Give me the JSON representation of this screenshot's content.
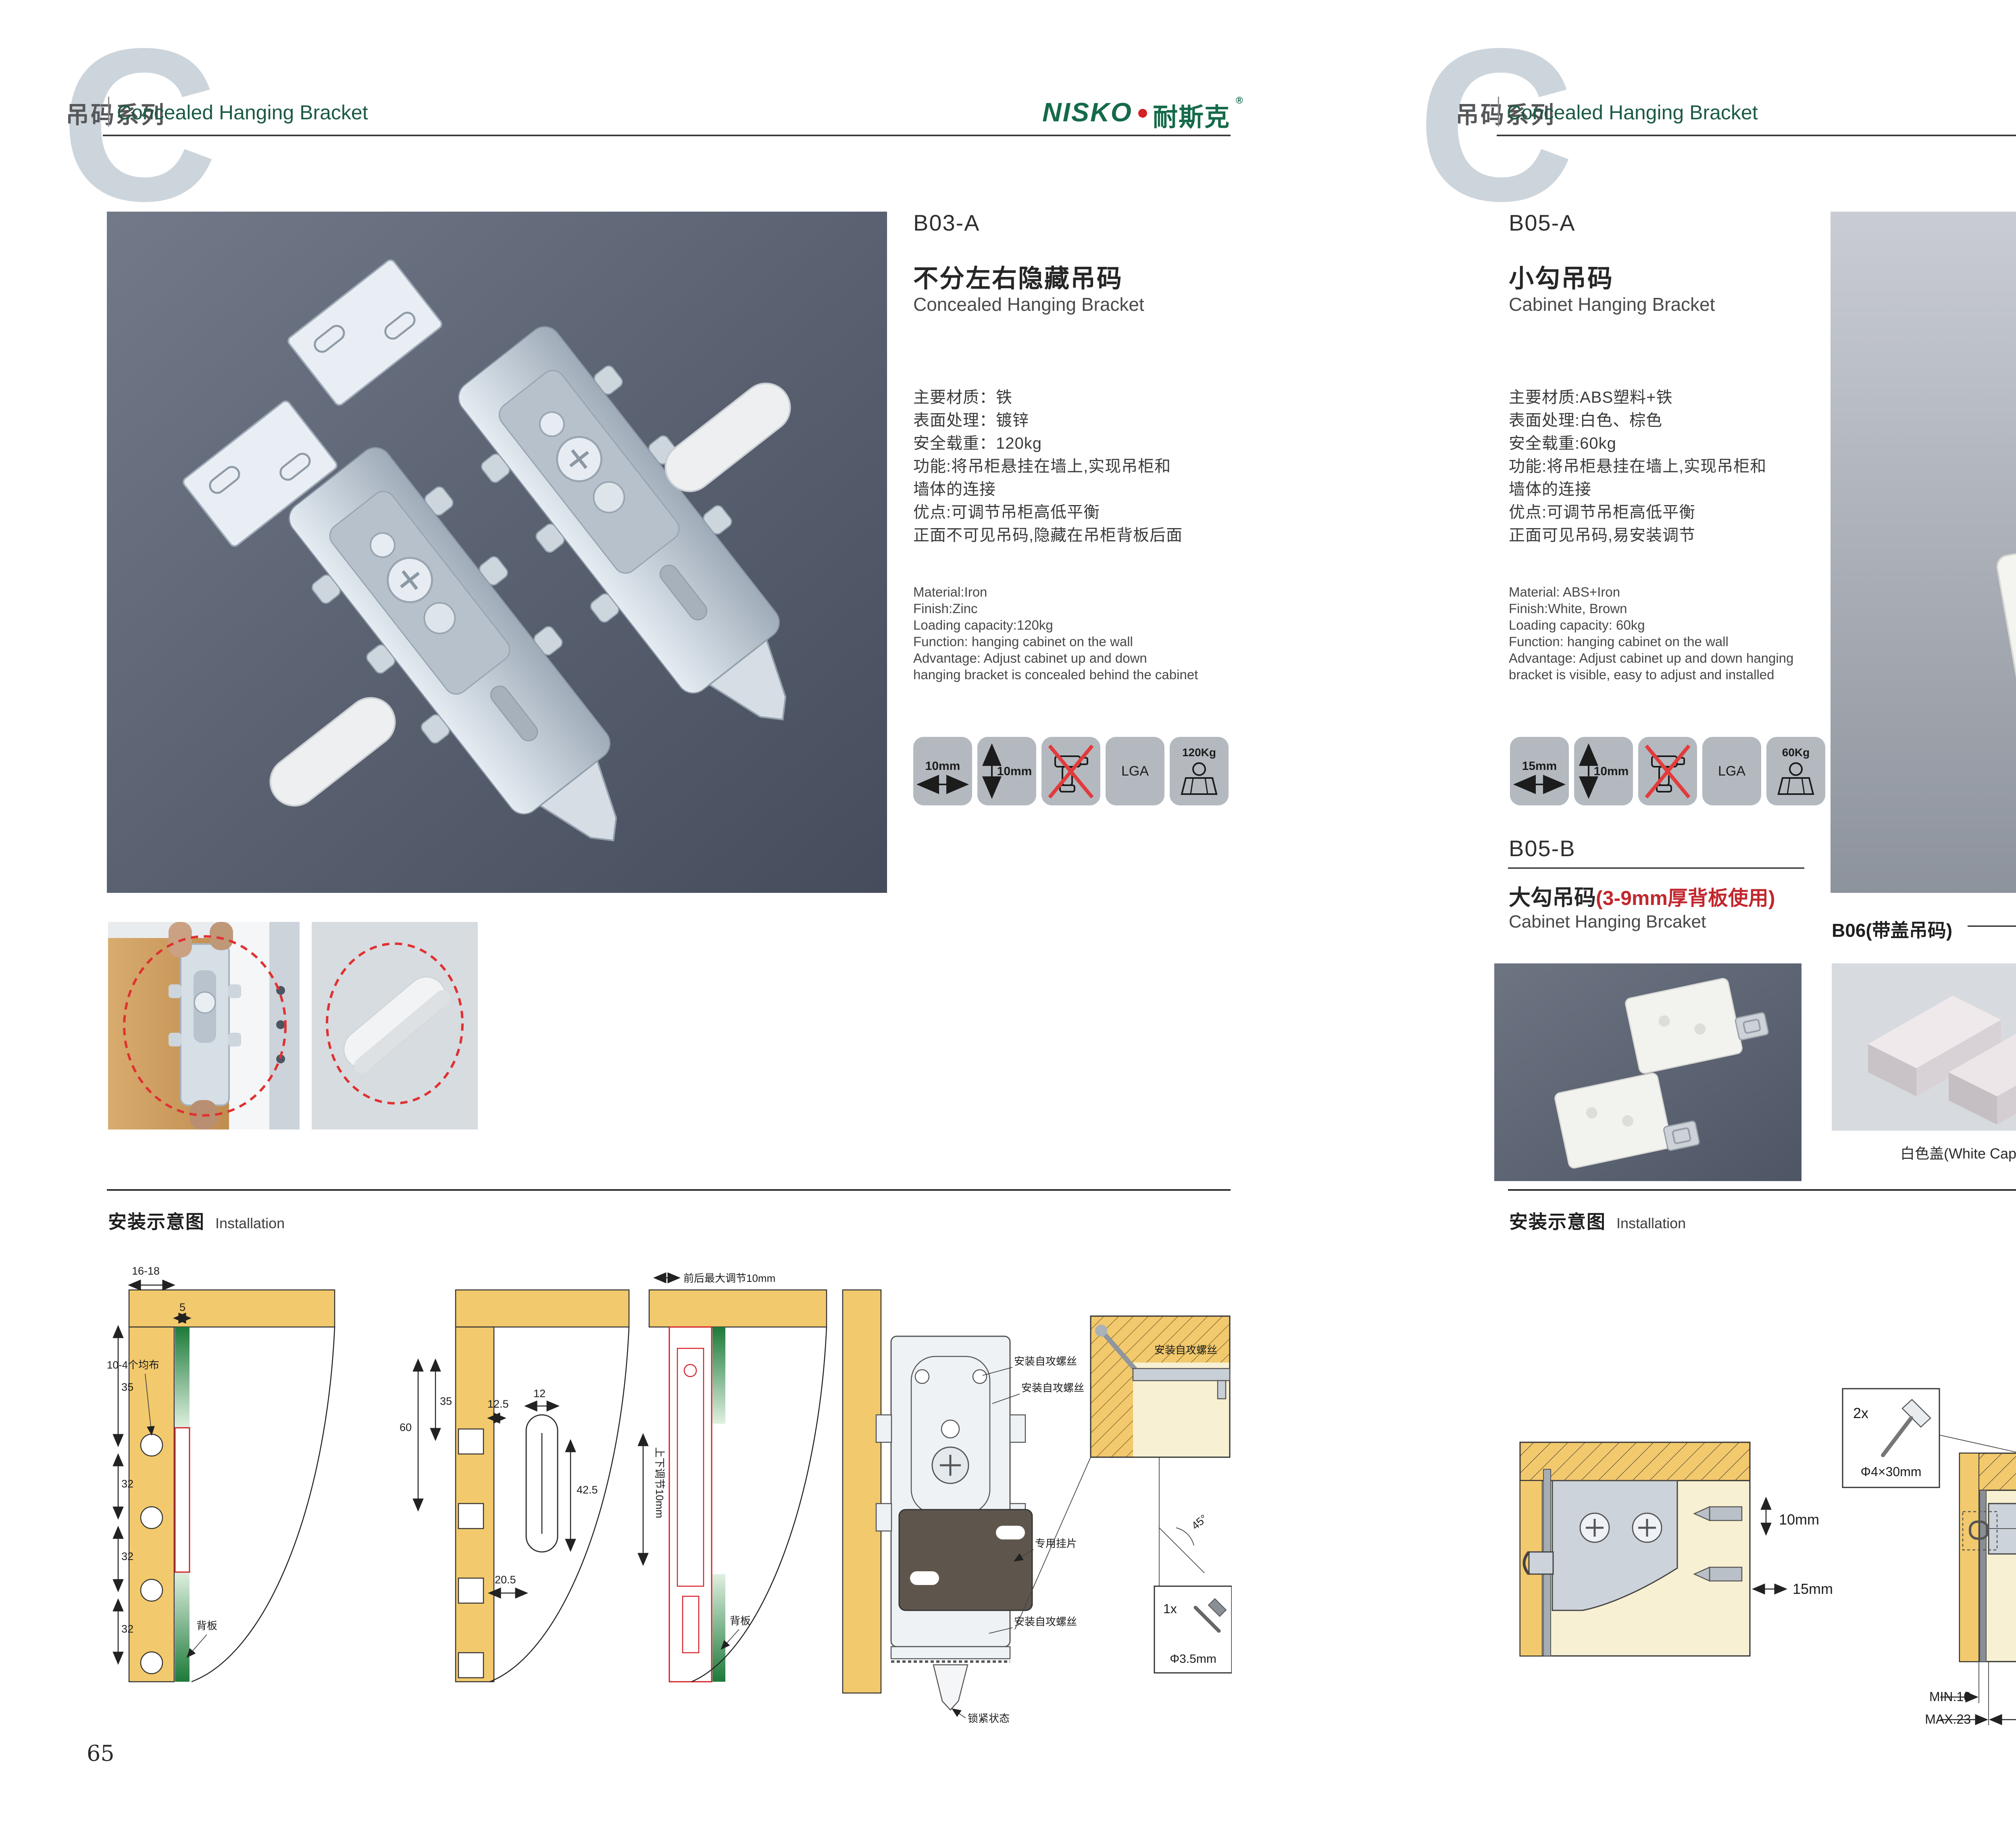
{
  "header": {
    "letter": "C",
    "series_cn": "吊码系列",
    "series_en": "Concealed Hanging Bracket"
  },
  "brand": {
    "logo_en": "NISKO",
    "logo_cn": "耐斯克",
    "registered": "®"
  },
  "footer": {
    "left_page": "65",
    "right_page": "66"
  },
  "installation": {
    "title_cn": "安装示意图",
    "title_en": "Installation"
  },
  "colors": {
    "accent_green": "#1b5a43",
    "logo_green": "#156a4a",
    "warn_red": "#c1272d",
    "wood": "#f2c96d",
    "icon_tile": "#b3b9bf"
  },
  "products": {
    "b03a": {
      "code": "B03-A",
      "name_cn": "不分左右隐藏吊码",
      "name_en": "Concealed Hanging Bracket",
      "specs_cn": [
        "主要材质：铁",
        "表面处理：镀锌",
        "安全载重：120kg",
        "功能:将吊柜悬挂在墙上,实现吊柜和",
        "墙体的连接",
        "优点:可调节吊柜高低平衡",
        "正面不可见吊码,隐藏在吊柜背板后面"
      ],
      "specs_en": [
        "Material:Iron",
        "Finish:Zinc",
        "Loading capacity:120kg",
        "Function: hanging cabinet on the wall",
        "Advantage: Adjust cabinet up and down",
        "hanging bracket is concealed behind the cabinet"
      ],
      "icons": {
        "width": "10mm",
        "height": "10mm",
        "cert": "LGA",
        "load": "120Kg"
      }
    },
    "b05a": {
      "code": "B05-A",
      "name_cn": "小勾吊码",
      "name_en": "Cabinet Hanging Bracket",
      "specs_cn": [
        "主要材质:ABS塑料+铁",
        "表面处理:白色、棕色",
        "安全载重:60kg",
        "功能:将吊柜悬挂在墙上,实现吊柜和",
        "墙体的连接",
        "优点:可调节吊柜高低平衡",
        "正面可见吊码,易安装调节"
      ],
      "specs_en": [
        "Material: ABS+Iron",
        "Finish:White, Brown",
        "Loading capacity: 60kg",
        "Function: hanging cabinet on the wall",
        "Advantage: Adjust cabinet up and down hanging",
        "bracket is visible, easy to adjust and installed"
      ],
      "icons": {
        "width": "15mm",
        "height": "10mm",
        "cert": "LGA",
        "load": "60Kg"
      }
    },
    "b05b": {
      "code": "B05-B",
      "name_cn": "大勾吊码",
      "name_note": "(3-9mm厚背板使用)",
      "name_en": "Cabinet Hanging Brcaket"
    },
    "b06": {
      "title": "B06(带盖吊码)",
      "caps": [
        {
          "label": "白色盖(White Cap)"
        },
        {
          "label": "灰色盖(Gray Cap)"
        },
        {
          "label": "银色盖(Silver Cap)"
        }
      ]
    }
  },
  "diagrams": {
    "left": {
      "d1": {
        "dim_top": "16-18",
        "dim_5": "5",
        "dim_35": "35",
        "dim_32a": "32",
        "dim_32b": "32",
        "dim_32c": "32",
        "label_holes": "10-4个均布",
        "label_back": "背板"
      },
      "d2": {
        "dim_35": "35",
        "dim_60": "60",
        "dim_125": "12.5",
        "dim_12": "12",
        "dim_425": "42.5",
        "dim_205": "20.5"
      },
      "d3": {
        "label_top": "前后最大调节10mm",
        "label_side": "上下调节10mm",
        "label_back": "背板"
      },
      "d4": {
        "label_screw1": "安装自攻螺丝",
        "label_screw2": "安装自攻螺丝",
        "label_plate": "专用挂片",
        "label_screw3": "安装自攻螺丝",
        "label_lock": "锁紧状态"
      },
      "d5": {
        "label_screw": "安装自攻螺丝",
        "angle": "45°",
        "qty": "1x",
        "size": "Φ3.5mm"
      }
    },
    "right": {
      "d1": {
        "dim_v": "10mm",
        "dim_h": "15mm",
        "qty": "2x",
        "size": "Φ4×30mm"
      },
      "d2": {
        "dim_18": "18",
        "dim_min": "MIN.10",
        "dim_max": "MAX.23",
        "dim_58": "58"
      },
      "d3": {
        "dim_16a": "16",
        "dim_42": "42",
        "dim_r": "RMAX4",
        "dim_16b": "16",
        "dim_17": "17",
        "dim_32": "32"
      }
    }
  }
}
